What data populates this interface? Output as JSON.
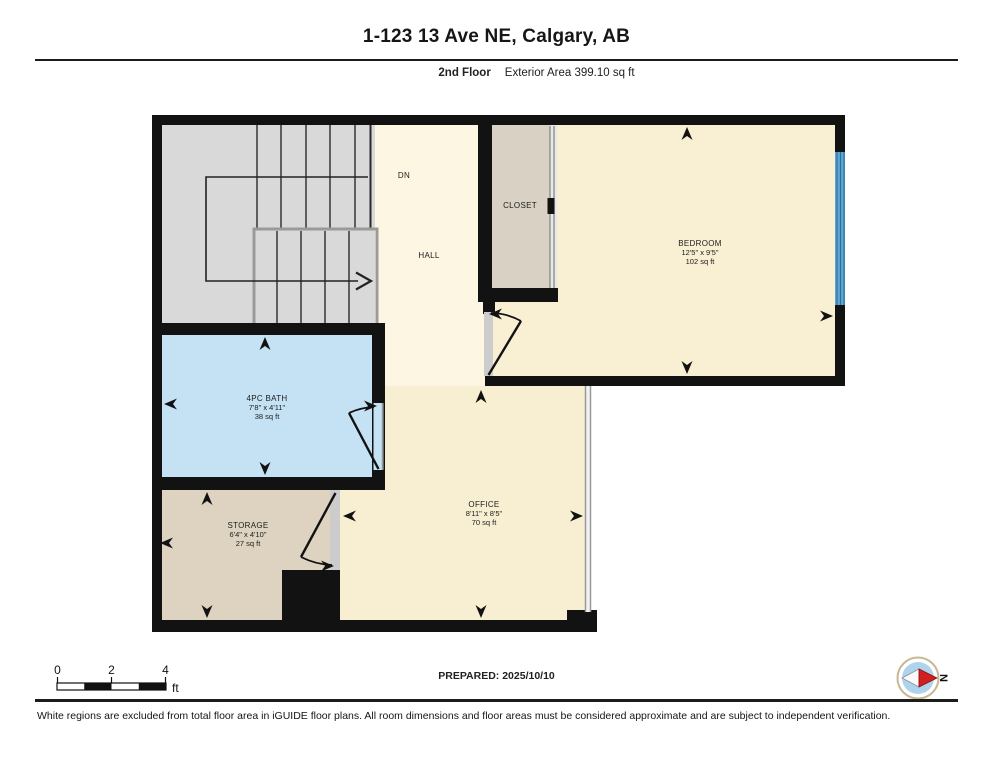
{
  "header": {
    "title": "1-123 13 Ave NE, Calgary, AB",
    "floor_label": "2nd Floor",
    "area_label": "Exterior Area 399.10 sq ft"
  },
  "rooms": {
    "bedroom": {
      "name": "BEDROOM",
      "dims": "12'5\" x 9'5\"",
      "area": "102 sq ft"
    },
    "bath": {
      "name": "4PC BATH",
      "dims": "7'8\" x 4'11\"",
      "area": "38 sq ft"
    },
    "office": {
      "name": "OFFICE",
      "dims": "8'11\" x 8'5\"",
      "area": "70 sq ft"
    },
    "storage": {
      "name": "STORAGE",
      "dims": "6'4\" x 4'10\"",
      "area": "27 sq ft"
    },
    "closet": {
      "name": "CLOSET"
    },
    "hall": {
      "name": "HALL"
    },
    "stairs": {
      "down_label": "DN"
    }
  },
  "scale_bar": {
    "tick0": "0",
    "tick2": "2",
    "tick4": "4",
    "unit": "ft"
  },
  "compass": {
    "north_label": "N"
  },
  "footer": {
    "prepared_label": "PREPARED: 2025/10/10",
    "disclaimer": "White regions are excluded from total floor area in iGUIDE floor plans. All room dimensions and floor areas must be considered approximate and are subject to independent verification."
  },
  "colors": {
    "wall": "#121212",
    "stairs": "#d9d9d9",
    "hall": "#fdf6e2",
    "bedroom": "#f9efd3",
    "office": "#f8eed2",
    "bath": "#c4e2f4",
    "closet": "#d9d1c4",
    "storage": "#ddd3c0",
    "window": "#5fa8d3",
    "door_opening": "#cccccc",
    "compass_red": "#d21f1f",
    "compass_inner": "#aed3ec"
  }
}
